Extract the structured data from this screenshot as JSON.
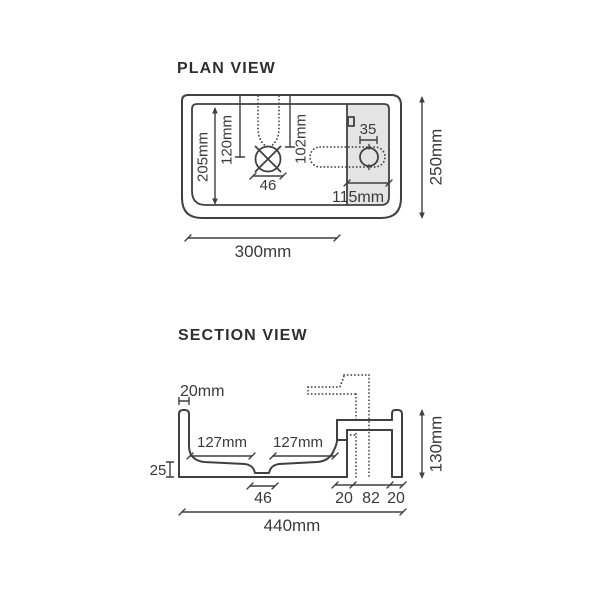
{
  "colors": {
    "line": "#404040",
    "text": "#3a3a3a",
    "shade": "#e4e4e4",
    "background": "#ffffff"
  },
  "plan_view": {
    "title": "PLAN VIEW",
    "dimensions": {
      "inner_depth": "205mm",
      "drain_offset_left": "120mm",
      "drain_offset_right": "102mm",
      "drain_width": "46",
      "tap_hole_diameter": "35",
      "deck_width": "115mm",
      "bowl_width": "300mm",
      "overall_depth": "250mm"
    }
  },
  "section_view": {
    "title": "SECTION VIEW",
    "dimensions": {
      "wall_thickness": "20mm",
      "bowl_left_half": "127mm",
      "bowl_right_half": "127mm",
      "base_thickness": "25",
      "drain_width": "46",
      "step_width": "20",
      "void_width": "82",
      "back_wall_width": "20",
      "overall_width": "440mm",
      "overall_height": "130mm"
    }
  }
}
